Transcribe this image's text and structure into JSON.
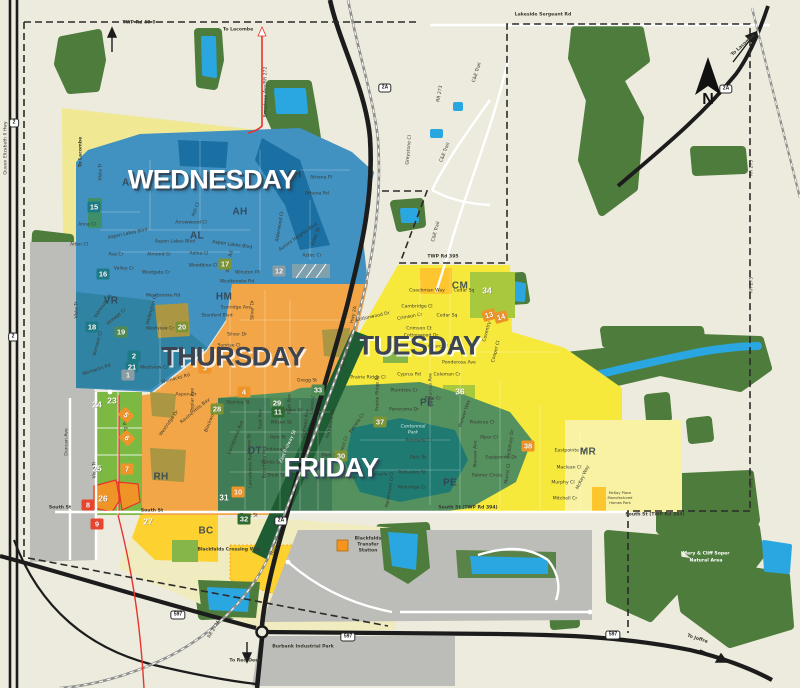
{
  "map": {
    "compass_letter": "N",
    "colors": {
      "land": "#edebdd",
      "forest": "#4e7c3c",
      "water": "#2aa7e0",
      "wednesday_blue": "#4191c1",
      "thursday_orange": "#f3a648",
      "tuesday_yellow": "#f6e93c",
      "friday_green": "#55915f",
      "industrial_gray": "#bcbcb8",
      "residential_green": "#7cb942",
      "boundary_dash": "#2b2b2b",
      "highway_red": "#e8332a"
    },
    "day_zones": [
      {
        "label": "WEDNESDAY",
        "x": 212,
        "y": 180,
        "style": "light"
      },
      {
        "label": "THURSDAY",
        "x": 233,
        "y": 357,
        "style": "dark"
      },
      {
        "label": "TUESDAY",
        "x": 419,
        "y": 346,
        "style": "dark"
      },
      {
        "label": "FRIDAY",
        "x": 331,
        "y": 468,
        "style": "light"
      }
    ],
    "area_codes": [
      {
        "code": "AL",
        "x": 129,
        "y": 183
      },
      {
        "code": "AL",
        "x": 197,
        "y": 236
      },
      {
        "code": "AH",
        "x": 294,
        "y": 175
      },
      {
        "code": "AH",
        "x": 240,
        "y": 212
      },
      {
        "code": "VR",
        "x": 111,
        "y": 301
      },
      {
        "code": "HM",
        "x": 224,
        "y": 297
      },
      {
        "code": "RH",
        "x": 161,
        "y": 477
      },
      {
        "code": "DT",
        "x": 255,
        "y": 451
      },
      {
        "code": "BC",
        "x": 206,
        "y": 531
      },
      {
        "code": "CM",
        "x": 460,
        "y": 286
      },
      {
        "code": "PE",
        "x": 427,
        "y": 403
      },
      {
        "code": "PE",
        "x": 450,
        "y": 483
      },
      {
        "code": "MR",
        "x": 588,
        "y": 452
      }
    ],
    "shields": [
      {
        "t": "2",
        "x": 14,
        "y": 123
      },
      {
        "t": "2",
        "x": 13,
        "y": 337
      },
      {
        "t": "2A",
        "x": 385,
        "y": 88
      },
      {
        "t": "2A",
        "x": 726,
        "y": 89
      },
      {
        "t": "2A",
        "x": 281,
        "y": 521
      },
      {
        "t": "597",
        "x": 178,
        "y": 615
      },
      {
        "t": "597",
        "x": 348,
        "y": 637
      },
      {
        "t": "597",
        "x": 613,
        "y": 635
      }
    ],
    "badges": [
      {
        "n": "15",
        "x": 94,
        "y": 207,
        "bg": "#1c7b86"
      },
      {
        "n": "16",
        "x": 103,
        "y": 274,
        "bg": "#1c7b86"
      },
      {
        "n": "17",
        "x": 225,
        "y": 264,
        "bg": "#7c9434"
      },
      {
        "n": "12",
        "x": 279,
        "y": 271,
        "bg": "#8a9da5"
      },
      {
        "n": "18",
        "x": 92,
        "y": 327,
        "bg": "#1c7b86"
      },
      {
        "n": "19",
        "x": 121,
        "y": 332,
        "bg": "#4f8a52"
      },
      {
        "n": "20",
        "x": 182,
        "y": 327,
        "bg": "#7c9434"
      },
      {
        "n": "21",
        "x": 132,
        "y": 367,
        "bg": "#1c7b86"
      },
      {
        "n": "2",
        "x": 134,
        "y": 356,
        "bg": "#1c7b86"
      },
      {
        "n": "1",
        "x": 128,
        "y": 375,
        "bg": "#8a9da5"
      },
      {
        "n": "24",
        "x": 97,
        "y": 404,
        "bg": null
      },
      {
        "n": "23",
        "x": 112,
        "y": 400,
        "bg": null
      },
      {
        "n": "25",
        "x": 97,
        "y": 468,
        "bg": null
      },
      {
        "n": "26",
        "x": 103,
        "y": 498,
        "bg": null
      },
      {
        "n": "8",
        "x": 88,
        "y": 505,
        "bg": "#e8452e"
      },
      {
        "n": "9",
        "x": 97,
        "y": 524,
        "bg": "#e8452e"
      },
      {
        "n": "7",
        "x": 127,
        "y": 469,
        "bg": "#ef9426"
      },
      {
        "n": "5",
        "x": 126,
        "y": 415,
        "bg": "#ef9426",
        "rot": 45
      },
      {
        "n": "6",
        "x": 127,
        "y": 438,
        "bg": "#ef9426",
        "rot": 45
      },
      {
        "n": "27",
        "x": 148,
        "y": 521,
        "bg": null
      },
      {
        "n": "28",
        "x": 217,
        "y": 409,
        "bg": "#7c9434"
      },
      {
        "n": "3",
        "x": 205,
        "y": 368,
        "bg": "#ef9426"
      },
      {
        "n": "4",
        "x": 244,
        "y": 392,
        "bg": "#ef9426"
      },
      {
        "n": "29",
        "x": 277,
        "y": 403,
        "bg": "#4f8a52"
      },
      {
        "n": "11",
        "x": 278,
        "y": 412,
        "bg": "#2e6b33"
      },
      {
        "n": "33",
        "x": 318,
        "y": 390,
        "bg": "#4f8a52"
      },
      {
        "n": "30",
        "x": 341,
        "y": 456,
        "bg": "#7c9434"
      },
      {
        "n": "31",
        "x": 224,
        "y": 497,
        "bg": null
      },
      {
        "n": "10",
        "x": 238,
        "y": 492,
        "bg": "#ef9426"
      },
      {
        "n": "32",
        "x": 244,
        "y": 519,
        "bg": "#2e6b33"
      },
      {
        "n": "34",
        "x": 487,
        "y": 290,
        "bg": null
      },
      {
        "n": "13",
        "x": 489,
        "y": 315,
        "bg": "#ef9426",
        "rot": -15
      },
      {
        "n": "14",
        "x": 501,
        "y": 317,
        "bg": "#ef9426",
        "rot": -15
      },
      {
        "n": "36",
        "x": 460,
        "y": 391,
        "bg": null
      },
      {
        "n": "37",
        "x": 380,
        "y": 422,
        "bg": "#7c9434"
      },
      {
        "n": "38",
        "x": 528,
        "y": 446,
        "bg": "#ef9426"
      }
    ],
    "labels": [
      {
        "t": "TWP Rd 40-0",
        "x": 139,
        "y": 24,
        "b": 1
      },
      {
        "t": "Lakeside Sergeant Rd",
        "x": 543,
        "y": 16,
        "b": 1
      },
      {
        "t": "To Lacombe",
        "x": 238,
        "y": 31,
        "b": 1
      },
      {
        "t": "To Lacombe",
        "x": 82,
        "y": 152,
        "r": -90,
        "b": 1
      },
      {
        "t": "To Lacombe",
        "x": 744,
        "y": 46,
        "r": -42,
        "b": 1
      },
      {
        "t": "Broadway Ave/RR 272",
        "x": 267,
        "y": 92,
        "r": -90
      },
      {
        "t": "RR 273",
        "x": 441,
        "y": 94,
        "r": -80
      },
      {
        "t": "Greystone Cl",
        "x": 410,
        "y": 150,
        "r": -85
      },
      {
        "t": "C&E Trail",
        "x": 478,
        "y": 73,
        "r": -72
      },
      {
        "t": "C&E Trail",
        "x": 446,
        "y": 153,
        "r": -68
      },
      {
        "t": "C&E Trail",
        "x": 437,
        "y": 232,
        "r": -75
      },
      {
        "t": "TWP Rd 395",
        "x": 443,
        "y": 258,
        "b": 1
      },
      {
        "t": "RR 275",
        "x": 753,
        "y": 168,
        "r": -90
      },
      {
        "t": "RR 275",
        "x": 753,
        "y": 285,
        "r": -90
      },
      {
        "t": "RR 275",
        "x": 753,
        "y": 480,
        "r": -90
      },
      {
        "t": "Queen Elizabeth II Hwy",
        "x": 7,
        "y": 148,
        "r": -90
      },
      {
        "t": "Hwy 2A",
        "x": 355,
        "y": 315,
        "r": -78
      },
      {
        "t": "Hwy 2A",
        "x": 277,
        "y": 548,
        "r": -62
      },
      {
        "t": "South St",
        "x": 60,
        "y": 509,
        "b": 1
      },
      {
        "t": "South St",
        "x": 152,
        "y": 512,
        "b": 1
      },
      {
        "t": "South St (TWP Rd 394)",
        "x": 468,
        "y": 509,
        "b": 1
      },
      {
        "t": "South St (TWP Rd 394)",
        "x": 655,
        "y": 516,
        "b": 1
      },
      {
        "t": "Duncan Ave",
        "x": 68,
        "y": 442,
        "r": -90
      },
      {
        "t": "Vista Tr",
        "x": 96,
        "y": 470,
        "r": -90
      },
      {
        "t": "Vista Tr",
        "x": 102,
        "y": 172,
        "r": -90
      },
      {
        "t": "Vista Tr",
        "x": 78,
        "y": 310,
        "r": -90
      },
      {
        "t": "RR 272A",
        "x": 215,
        "y": 630,
        "r": -60
      },
      {
        "t": "To Red Deer",
        "x": 245,
        "y": 662,
        "b": 1
      },
      {
        "t": "To Joffre",
        "x": 697,
        "y": 640,
        "r": 18,
        "b": 1
      },
      {
        "t": "Burbank Industrial Park",
        "x": 303,
        "y": 648,
        "b": 1
      },
      {
        "t": "Mary & Cliff Soper",
        "x": 706,
        "y": 555,
        "c": "w",
        "b": 1
      },
      {
        "t": "Natural Area",
        "x": 706,
        "y": 562,
        "c": "w",
        "b": 1
      },
      {
        "t": "Blackfalds",
        "x": 368,
        "y": 540,
        "b": 1
      },
      {
        "t": "Transfer",
        "x": 368,
        "y": 546,
        "b": 1
      },
      {
        "t": "Station",
        "x": 368,
        "y": 552,
        "b": 1
      },
      {
        "t": "Blackfalds Crossing Way",
        "x": 229,
        "y": 551,
        "b": 1
      },
      {
        "t": "East Railway St",
        "x": 289,
        "y": 447,
        "r": -66,
        "c": "w"
      },
      {
        "t": "Centennial",
        "x": 413,
        "y": 428,
        "c": "pk"
      },
      {
        "t": "Park",
        "x": 413,
        "y": 434,
        "c": "pk"
      },
      {
        "t": "McKay Place",
        "x": 620,
        "y": 494,
        "s": 3.6
      },
      {
        "t": "Manufactured",
        "x": 620,
        "y": 499,
        "s": 3.6
      },
      {
        "t": "Homes Park",
        "x": 620,
        "y": 504,
        "s": 3.6
      },
      {
        "t": "Anna Cl",
        "x": 87,
        "y": 226
      },
      {
        "t": "Aspen Lakes Blvd",
        "x": 128,
        "y": 235,
        "r": -12
      },
      {
        "t": "Aspen Lakes Blvd",
        "x": 175,
        "y": 243
      },
      {
        "t": "Aspen Lakes Blvd",
        "x": 232,
        "y": 246,
        "r": 8
      },
      {
        "t": "Arlen Cl",
        "x": 79,
        "y": 246
      },
      {
        "t": "Ava Cr",
        "x": 116,
        "y": 256
      },
      {
        "t": "Valley Cr",
        "x": 124,
        "y": 270
      },
      {
        "t": "Westgate Cr",
        "x": 156,
        "y": 274
      },
      {
        "t": "Almond Cr",
        "x": 159,
        "y": 256
      },
      {
        "t": "Adina Cl",
        "x": 199,
        "y": 255
      },
      {
        "t": "Woodbine Cl",
        "x": 203,
        "y": 267
      },
      {
        "t": "Arrowwood Cl",
        "x": 191,
        "y": 224
      },
      {
        "t": "Ash Cl",
        "x": 197,
        "y": 210,
        "r": -70
      },
      {
        "t": "Willow Rd",
        "x": 231,
        "y": 262,
        "r": -80
      },
      {
        "t": "Winston Pl",
        "x": 247,
        "y": 274
      },
      {
        "t": "Westbrooke Rd",
        "x": 237,
        "y": 283
      },
      {
        "t": "Westbrooke Rd",
        "x": 163,
        "y": 297
      },
      {
        "t": "Athena Pl",
        "x": 321,
        "y": 179
      },
      {
        "t": "Athena Rd",
        "x": 317,
        "y": 195
      },
      {
        "t": "Aurora Heights Blvd",
        "x": 299,
        "y": 238,
        "r": -35
      },
      {
        "t": "Alderwood Cl",
        "x": 281,
        "y": 227,
        "r": -80
      },
      {
        "t": "Aztec St",
        "x": 317,
        "y": 237,
        "r": -70
      },
      {
        "t": "Aztec Cr",
        "x": 312,
        "y": 257
      },
      {
        "t": "Valmount St",
        "x": 104,
        "y": 307,
        "r": -55
      },
      {
        "t": "Vintage Cl",
        "x": 117,
        "y": 318,
        "r": -40
      },
      {
        "t": "Vermont Cl",
        "x": 99,
        "y": 344,
        "r": -75
      },
      {
        "t": "Womacks Rd",
        "x": 97,
        "y": 371,
        "r": -18
      },
      {
        "t": "Womacks Rd",
        "x": 176,
        "y": 380,
        "r": -15
      },
      {
        "t": "Wellington Cl",
        "x": 153,
        "y": 310,
        "r": -75
      },
      {
        "t": "Sunridge Ave",
        "x": 236,
        "y": 309
      },
      {
        "t": "Stanford Blvd",
        "x": 217,
        "y": 317
      },
      {
        "t": "Silver Dr",
        "x": 237,
        "y": 336
      },
      {
        "t": "Silver Dr",
        "x": 254,
        "y": 310,
        "r": -90
      },
      {
        "t": "Sunrise Cl",
        "x": 229,
        "y": 347
      },
      {
        "t": "Westview Cr",
        "x": 160,
        "y": 330
      },
      {
        "t": "Westview Cr",
        "x": 154,
        "y": 369
      },
      {
        "t": "Aspen Dr",
        "x": 186,
        "y": 396
      },
      {
        "t": "Poplar Ave",
        "x": 194,
        "y": 400,
        "r": -90
      },
      {
        "t": "Stanley St",
        "x": 238,
        "y": 404
      },
      {
        "t": "Gregg St",
        "x": 307,
        "y": 382
      },
      {
        "t": "Leung Rd",
        "x": 127,
        "y": 430,
        "r": -90
      },
      {
        "t": "Westridge Dr",
        "x": 170,
        "y": 424,
        "r": -55
      },
      {
        "t": "Blackwood Cr",
        "x": 213,
        "y": 418,
        "r": -68
      },
      {
        "t": "Ravine Hills Bay",
        "x": 196,
        "y": 412,
        "r": -40
      },
      {
        "t": "Lansdowne Ave",
        "x": 237,
        "y": 438,
        "r": -68
      },
      {
        "t": "Coachman Way",
        "x": 427,
        "y": 292
      },
      {
        "t": "Cedar Sq",
        "x": 464,
        "y": 292
      },
      {
        "t": "Cedar Sq",
        "x": 447,
        "y": 317
      },
      {
        "t": "Cambridge Cl",
        "x": 417,
        "y": 308
      },
      {
        "t": "Crimson Cr",
        "x": 410,
        "y": 318,
        "r": -10
      },
      {
        "t": "Crimson Ct",
        "x": 419,
        "y": 330
      },
      {
        "t": "Cottonwood Dr",
        "x": 421,
        "y": 337
      },
      {
        "t": "Cottonwood Dr",
        "x": 373,
        "y": 318,
        "r": -12
      },
      {
        "t": "Churchill Pl",
        "x": 441,
        "y": 348
      },
      {
        "t": "Ponderosa Ave",
        "x": 459,
        "y": 364
      },
      {
        "t": "Ponderosa Ave",
        "x": 432,
        "y": 390,
        "r": -90
      },
      {
        "t": "Cyprus Rd",
        "x": 409,
        "y": 376
      },
      {
        "t": "Prairie Ridge Cl",
        "x": 368,
        "y": 379
      },
      {
        "t": "Pinewood Rd",
        "x": 347,
        "y": 356,
        "r": -75
      },
      {
        "t": "Prairie Ridge Av",
        "x": 379,
        "y": 393,
        "r": -90
      },
      {
        "t": "Plumtree Cr",
        "x": 404,
        "y": 392
      },
      {
        "t": "Pine Cr",
        "x": 433,
        "y": 400
      },
      {
        "t": "Coleman Cr",
        "x": 447,
        "y": 376
      },
      {
        "t": "Coventry Cl",
        "x": 489,
        "y": 329,
        "r": -75
      },
      {
        "t": "Cooper Cl",
        "x": 497,
        "y": 352,
        "r": -75
      },
      {
        "t": "Panorama Dr",
        "x": 404,
        "y": 411
      },
      {
        "t": "Pondside Cr",
        "x": 419,
        "y": 442
      },
      {
        "t": "Park St",
        "x": 418,
        "y": 459
      },
      {
        "t": "Park St",
        "x": 330,
        "y": 457
      },
      {
        "t": "Palisades St",
        "x": 412,
        "y": 474
      },
      {
        "t": "Parkridge Cr",
        "x": 412,
        "y": 489
      },
      {
        "t": "Pinnacle Cl",
        "x": 381,
        "y": 476
      },
      {
        "t": "Parkway Cl",
        "x": 351,
        "y": 479
      },
      {
        "t": "Paramount Cr",
        "x": 391,
        "y": 492,
        "r": -80
      },
      {
        "t": "Parkwood Rd",
        "x": 332,
        "y": 424,
        "r": -78
      },
      {
        "t": "Prospect Cr",
        "x": 344,
        "y": 449,
        "r": -72
      },
      {
        "t": "Pamela Cr",
        "x": 358,
        "y": 424,
        "r": -55
      },
      {
        "t": "Pioneer Way",
        "x": 466,
        "y": 414,
        "r": -72
      },
      {
        "t": "Pinetree Cl",
        "x": 482,
        "y": 424
      },
      {
        "t": "Piper Cl",
        "x": 489,
        "y": 439
      },
      {
        "t": "Pioneer Ave",
        "x": 477,
        "y": 454,
        "r": -90
      },
      {
        "t": "Eastpointe Dr",
        "x": 501,
        "y": 459
      },
      {
        "t": "Eastpointe Cr",
        "x": 570,
        "y": 452
      },
      {
        "t": "Palmer Circle",
        "x": 487,
        "y": 477
      },
      {
        "t": "McKelvey Dr",
        "x": 512,
        "y": 444,
        "r": -82
      },
      {
        "t": "Morris Cl",
        "x": 509,
        "y": 474,
        "r": -82
      },
      {
        "t": "Maclean Cl",
        "x": 569,
        "y": 469
      },
      {
        "t": "Murphy Cl",
        "x": 563,
        "y": 484
      },
      {
        "t": "Mitchell Cr",
        "x": 565,
        "y": 500
      },
      {
        "t": "McKay Way",
        "x": 584,
        "y": 478,
        "r": -65
      },
      {
        "t": "Waghorn St",
        "x": 289,
        "y": 412
      },
      {
        "t": "Wilson St",
        "x": 281,
        "y": 424
      },
      {
        "t": "East Ave",
        "x": 291,
        "y": 404,
        "r": -90
      },
      {
        "t": "East Ave",
        "x": 262,
        "y": 419,
        "r": -90
      },
      {
        "t": "Park St",
        "x": 278,
        "y": 439
      },
      {
        "t": "Indiana St",
        "x": 277,
        "y": 451
      },
      {
        "t": "Winks St",
        "x": 271,
        "y": 464
      },
      {
        "t": "Shull St",
        "x": 276,
        "y": 477
      },
      {
        "t": "Highway Ave",
        "x": 307,
        "y": 424,
        "r": -82
      },
      {
        "t": "Queen Cl",
        "x": 314,
        "y": 404,
        "r": -82
      },
      {
        "t": "Moore St",
        "x": 251,
        "y": 444,
        "r": -90
      },
      {
        "t": "Lansdowne Ave",
        "x": 252,
        "y": 470,
        "r": -90
      },
      {
        "t": "Broadway Ave",
        "x": 266,
        "y": 462,
        "r": -90
      },
      {
        "t": "Trout St",
        "x": 249,
        "y": 517
      }
    ]
  }
}
